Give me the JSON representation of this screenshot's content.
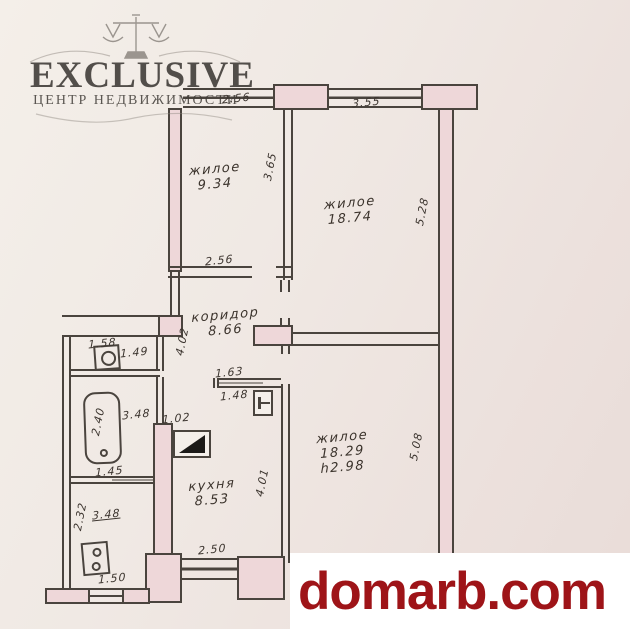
{
  "watermark": {
    "brand": "EXCLUSIVE",
    "tagline": "ЦЕНТР НЕДВИЖИМОСТИ"
  },
  "footer": {
    "site": "domarb.com"
  },
  "colors": {
    "paper": "#efe8e3",
    "wall_fill": "#eed7d9",
    "line": "#4a443e",
    "brand_red": "#9e1418",
    "logo_gray": "#37332f"
  },
  "plan": {
    "rooms": {
      "room1": {
        "label": "жилое",
        "area": "9.34"
      },
      "room2": {
        "label": "жилое",
        "area": "18.74"
      },
      "corridor": {
        "label": "коридор",
        "area": "8.66"
      },
      "room3": {
        "label": "жилое",
        "area": "18.29",
        "ceiling_height": "h2.98"
      },
      "kitchen": {
        "label": "кухня",
        "area": "8.53"
      }
    },
    "dims": {
      "room1_width": "2.56",
      "room2_width": "3.55",
      "room1_depth": "3.65",
      "room2_depth": "5.28",
      "corridor_width": "2.56",
      "wc_width": "1.58",
      "wc_depth": "1.49",
      "corridor_length": "4.02",
      "hatch_width": "1.63",
      "hatch_inner": "1.48",
      "bath_length": "3.48",
      "bath_gap": "1.02",
      "tub_length": "2.40",
      "bath_width": "1.45",
      "pantry_width": "2.32",
      "pantry_length": "3.48",
      "pantry_window": "1.50",
      "kitchen_depth": "4.01",
      "kitchen_width": "2.50",
      "room3_depth": "5.08"
    }
  }
}
